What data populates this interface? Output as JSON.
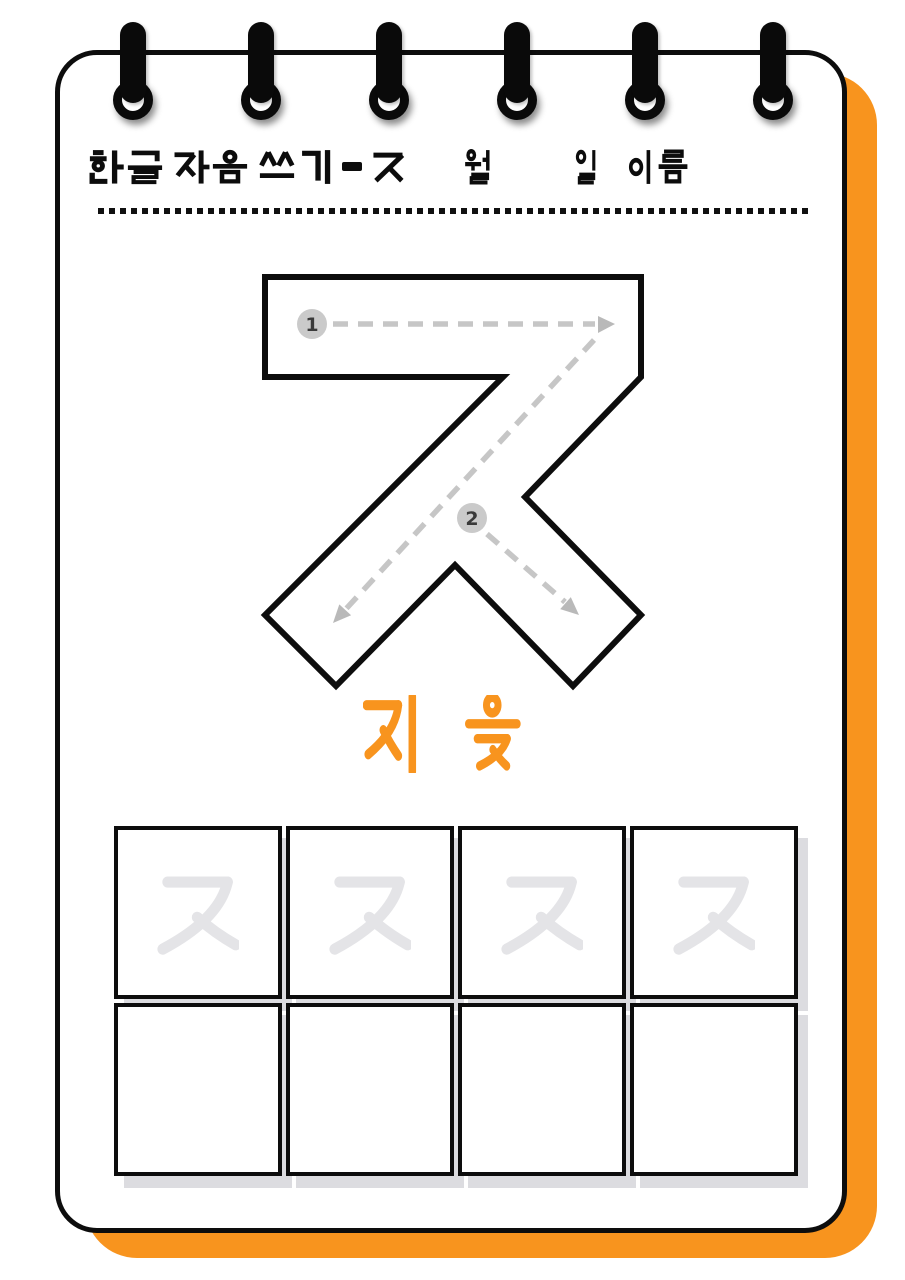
{
  "worksheet": {
    "title": "한글 자음 쓰기 - ㅈ",
    "title_syllables": [
      "한",
      "글",
      "자",
      "음",
      "쓰",
      "기",
      "-",
      "ㅈ"
    ],
    "month_label": "월",
    "day_label": "일",
    "name_label": "이름",
    "target_letter": "ㅈ",
    "letter_name": "지읒",
    "letter_name_syllables": [
      "지",
      "읒"
    ],
    "stroke_guide": {
      "stroke_1_number": "1",
      "stroke_2_number": "2"
    },
    "practice_grid": {
      "rows": 2,
      "columns": 4,
      "trace_row": [
        "ㅈ",
        "ㅈ",
        "ㅈ",
        "ㅈ"
      ],
      "empty_row": [
        "",
        "",
        "",
        ""
      ]
    },
    "colors": {
      "accent_orange": "#F8941E",
      "trace_gray": "#E4E4E7",
      "guide_gray": "#C6C6C6",
      "ink_black": "#0D0D0D"
    }
  }
}
